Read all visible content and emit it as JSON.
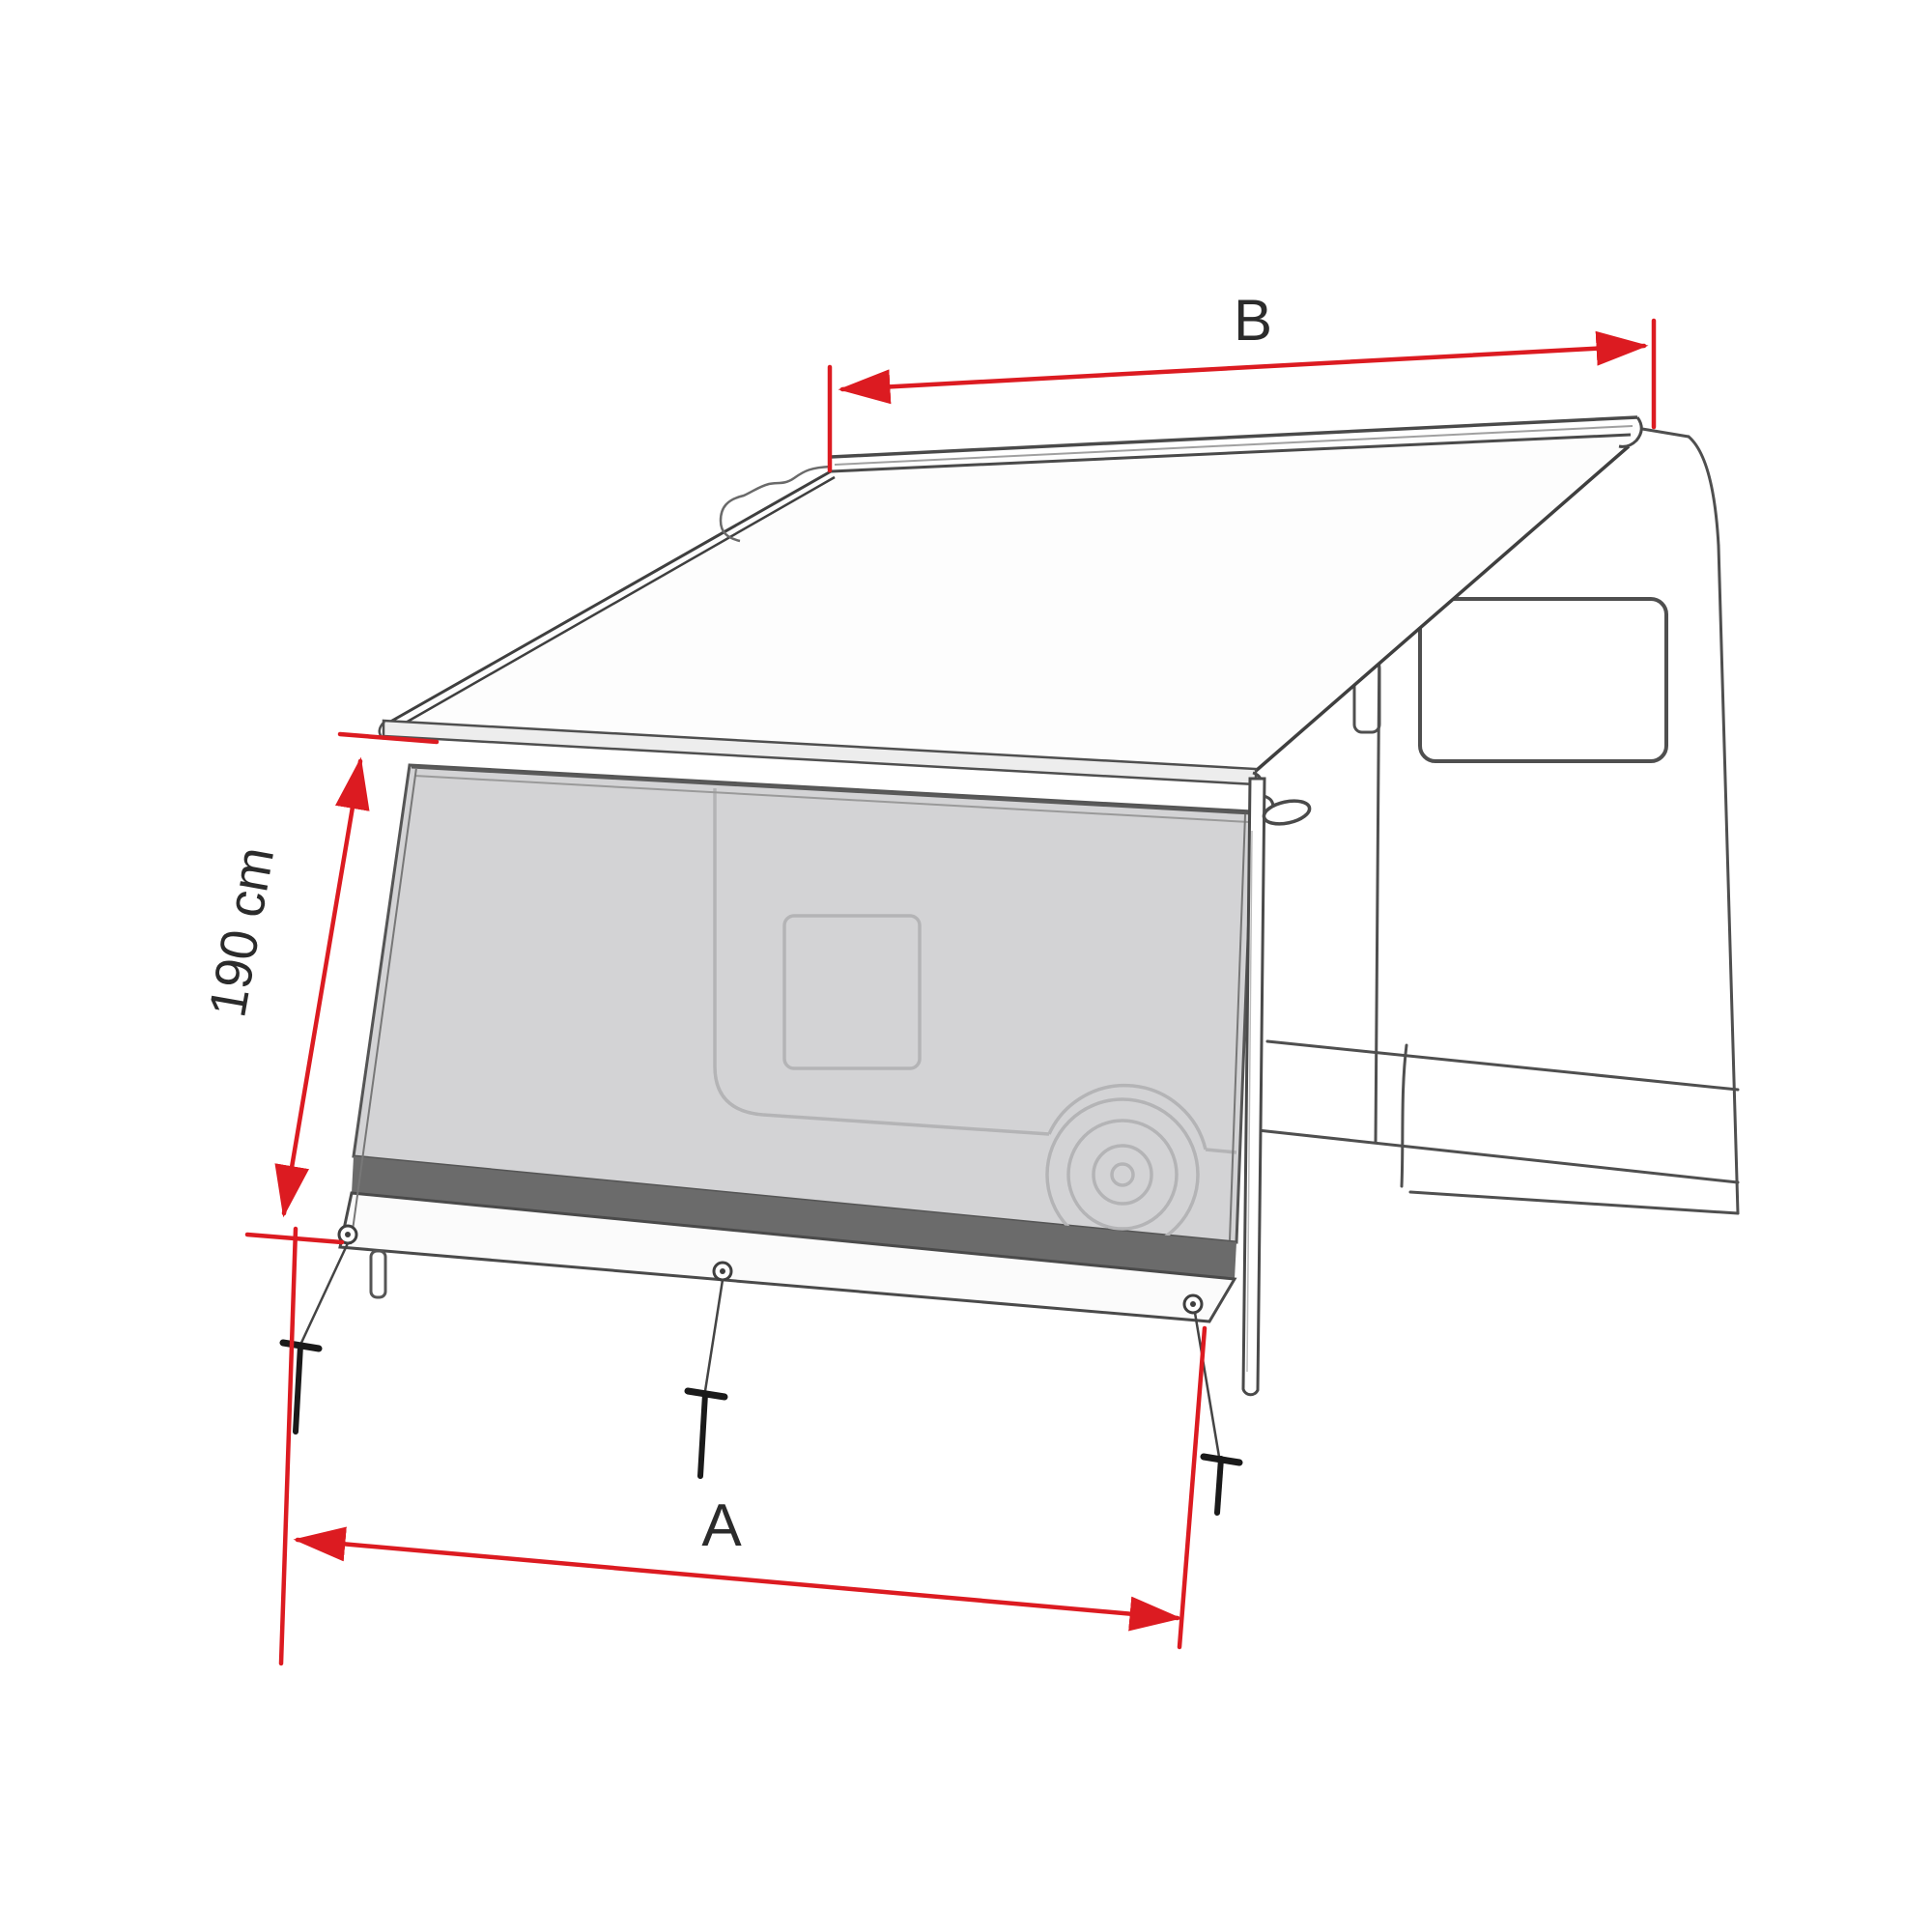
{
  "diagram": {
    "labels": {
      "dim_a": "A",
      "dim_b": "B",
      "dim_height": "190 cm"
    },
    "colors": {
      "background": "#ffffff",
      "dimension_red": "#dc1b21",
      "line_art": "#4a4a4a",
      "mesh_fill": "#d3d3d5",
      "mesh_silhouette": "#b4b4b6",
      "bottom_stripe": "#6b6b6b",
      "panel_band": "#fbfbfb",
      "label_text": "#2b2b2b"
    }
  }
}
